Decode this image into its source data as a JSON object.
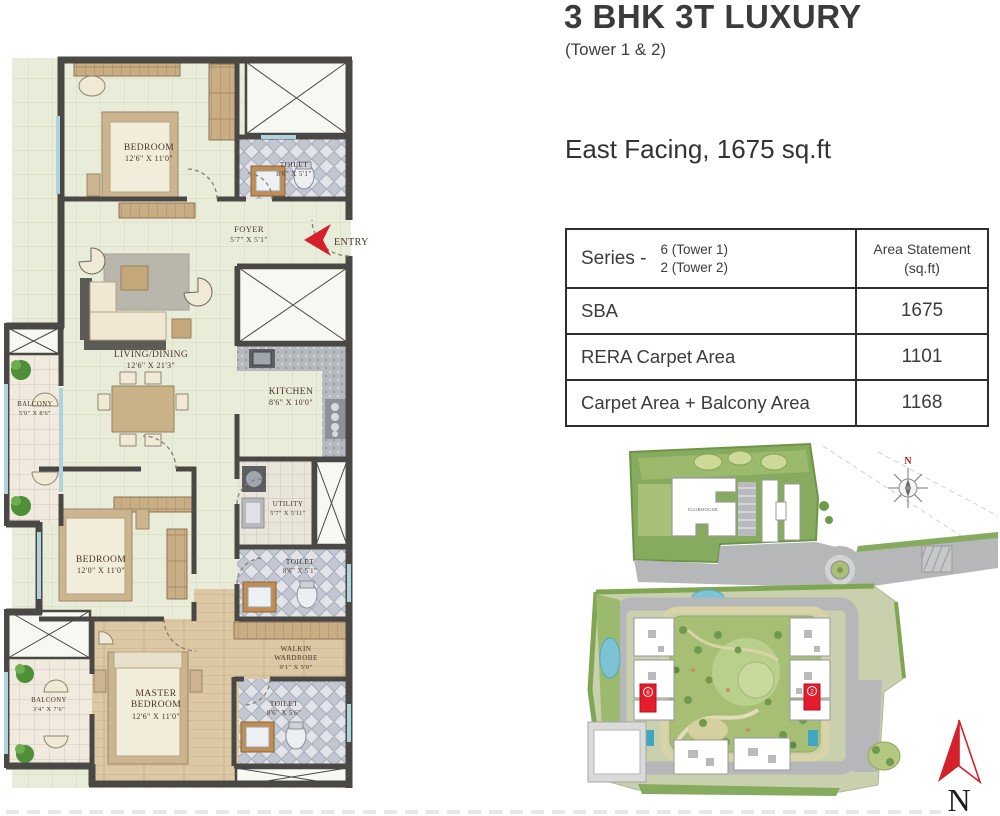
{
  "header": {
    "title": "3 BHK 3T LUXURY",
    "subtitle": "(Tower 1 & 2)",
    "facing": "East Facing, 1675 sq.ft"
  },
  "area_table": {
    "series_label": "Series -",
    "series_line1": "6 (Tower 1)",
    "series_line2": "2 (Tower 2)",
    "area_header_line1": "Area Statement",
    "area_header_line2": "(sq.ft)",
    "rows": [
      {
        "label": "SBA",
        "value": "1675"
      },
      {
        "label": "RERA Carpet Area",
        "value": "1101"
      },
      {
        "label": "Carpet Area + Balcony Area",
        "value": "1168"
      }
    ]
  },
  "floor_plan": {
    "entry_label": "ENTRY",
    "rooms": {
      "bedroom1": {
        "label": "BEDROOM",
        "dims": "12'6\" X 11'0\""
      },
      "toilet1": {
        "label": "TOILET",
        "dims": "8'6\" X 5'1\""
      },
      "foyer": {
        "label": "FOYER",
        "dims": "5'7\" X 5'1\""
      },
      "living": {
        "label": "LIVING/DINING",
        "dims": "12'6\" X 21'3\""
      },
      "balcony1": {
        "label": "BALCONY",
        "dims": "5'0\" X 8'6\""
      },
      "kitchen": {
        "label": "KITCHEN",
        "dims": "8'6\" X 10'0\""
      },
      "bedroom2": {
        "label": "BEDROOM",
        "dims": "12'0\" X 11'0\""
      },
      "utility": {
        "label": "UTILITY",
        "dims": "5'7\" X 5'11\""
      },
      "toilet2": {
        "label": "TOILET",
        "dims": "8'6\" X 5'1\""
      },
      "wardrobe": {
        "label1": "WALKIN",
        "label2": "WARDROBE",
        "dims": "9'1\" X 5'0\""
      },
      "master": {
        "label1": "MASTER",
        "label2": "BEDROOM",
        "dims": "12'6\" X 11'0\""
      },
      "balcony2": {
        "label": "BALCONY",
        "dims": "3'4\" X 7'6\""
      },
      "toilet3": {
        "label": "TOILET",
        "dims": "8'6\" X 5'6\""
      }
    }
  },
  "site_map": {
    "clubhouse_label": "CLUBHOUSE",
    "north_label": "N",
    "unit_marker_left": "6",
    "unit_marker_right": "2"
  },
  "compass": {
    "north_label": "N"
  },
  "colors": {
    "accent_red": "#d4202a",
    "wall": "#4a4845",
    "floor_green": "#e9ecd9",
    "title_text": "#3b3b3b"
  }
}
